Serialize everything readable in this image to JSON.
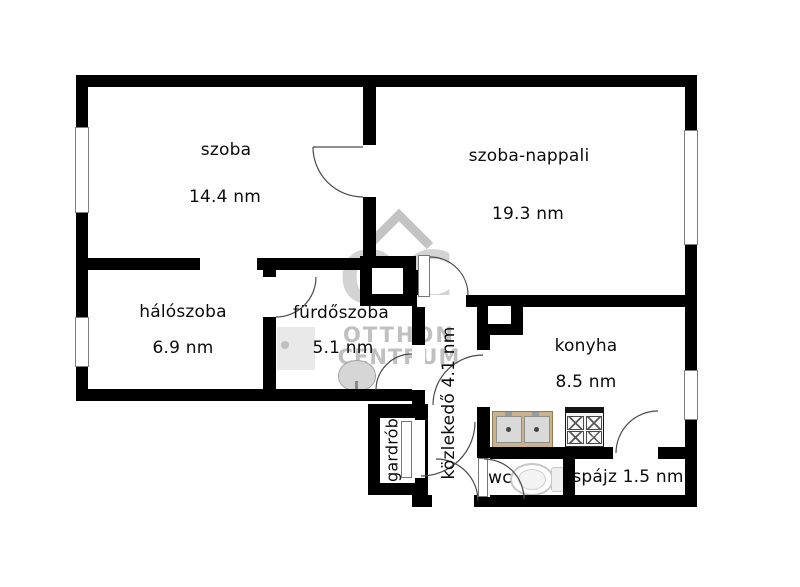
{
  "watermark": {
    "monogram": "OC",
    "line1": "OTTHON",
    "line2": "CENTRUM"
  },
  "rooms": {
    "szoba": {
      "name": "szoba",
      "area": "14.4 nm"
    },
    "szoba_nappali": {
      "name": "szoba-nappali",
      "area": "19.3 nm"
    },
    "haloszoba": {
      "name": "hálószoba",
      "area": "6.9 nm"
    },
    "furdoszoba": {
      "name": "fürdőszoba",
      "area": "5.1 nm"
    },
    "konyha": {
      "name": "konyha",
      "area": "8.5 nm"
    },
    "kozlekedo": {
      "label": "közlekedő 4.1 nm"
    },
    "gardrob": {
      "label": "gardrób"
    },
    "wc": {
      "label": "wc"
    },
    "spajz": {
      "label": "spájz 1.5 nm"
    }
  },
  "colors": {
    "wall": "#000000",
    "watermark_gray": "#bfbfbf",
    "counter_wood": "#c9b28c",
    "fixture_gray": "#d9d9d9",
    "door_arc": "#4a4a4a"
  }
}
